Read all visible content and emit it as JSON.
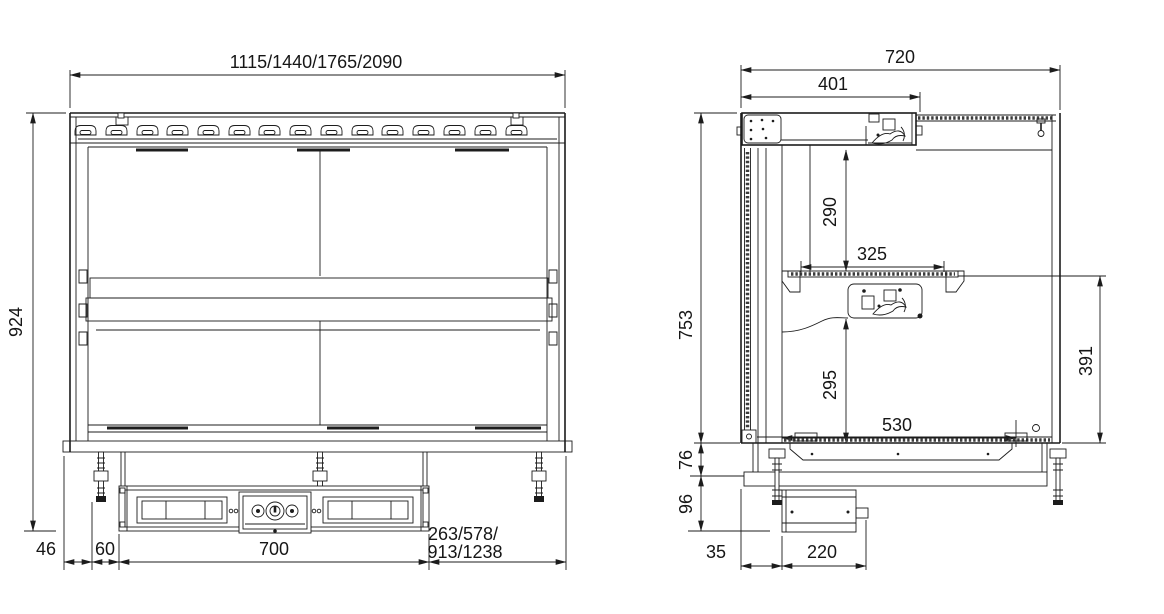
{
  "page": {
    "background": "#ffffff",
    "line_color": "#1c1c1c"
  },
  "views": {
    "front": {
      "name": "front-view",
      "dims": {
        "overall_width": "1115/1440/1765/2090",
        "overall_height": "924",
        "edge_to_leg": "46",
        "leg_to_recess": "60",
        "recess_width": "700",
        "right_offset": [
          "263/578/",
          "913/1238"
        ]
      }
    },
    "side": {
      "name": "side-view",
      "dims": {
        "overall_depth": "720",
        "housing_depth": "401",
        "housing_to_shelf": "290",
        "shelf_depth": "325",
        "body_height": "753",
        "shelf_to_base": "391",
        "under_shelf_clearance": "295",
        "interior_depth": "530",
        "frame_height": "76",
        "box_height": "96",
        "box_offset": "35",
        "box_depth": "220"
      }
    }
  }
}
